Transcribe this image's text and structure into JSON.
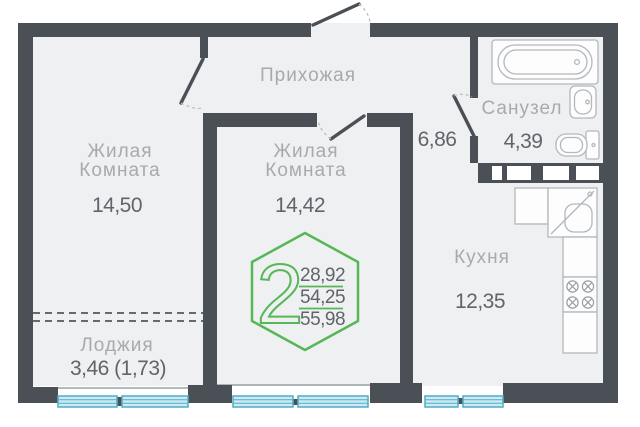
{
  "floor_plan": {
    "badge": {
      "rooms_count": "2",
      "living_area": "28,92",
      "area_without_loggia": "54,25",
      "total_area": "55,98"
    },
    "rooms": {
      "hallway": {
        "name": "Прихожая",
        "area": "6,86"
      },
      "living1": {
        "name_line1": "Жилая",
        "name_line2": "Комната",
        "area": "14,50"
      },
      "living2": {
        "name_line1": "Жилая",
        "name_line2": "Комната",
        "area": "14,42"
      },
      "bathroom": {
        "name": "Санузел",
        "area": "4,39"
      },
      "kitchen": {
        "name": "Кухня",
        "area": "12,35"
      },
      "loggia": {
        "name": "Лоджия",
        "area": "3,46 (1,73)"
      }
    },
    "colors": {
      "wall": "#4a5055",
      "floor": "#eef0f2",
      "accent": "#57b757",
      "window_fill": "#cfeaf4",
      "window_stroke": "#4fadc6",
      "label": "#a6abaf",
      "value": "#5f656a",
      "fixture": "#b2b8bc"
    }
  }
}
